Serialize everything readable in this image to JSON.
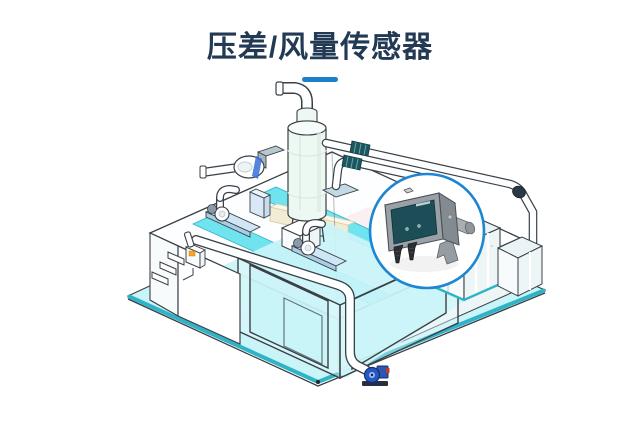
{
  "header": {
    "title": "压差/风量传感器",
    "divider": "title-underline-bar"
  },
  "illustration": {
    "alt": "isometric-cleanroom-hvac-system",
    "callout_device": "differential-pressure-air-volume-sensor",
    "elements": [
      "cleanroom-floor",
      "cleanroom-roof",
      "partition-walls",
      "scrubber-tank",
      "blower-pump",
      "roof-duct-fan-left",
      "roof-duct-fan-right",
      "exhaust-piping",
      "flex-duct-connector",
      "ahu-cabinet",
      "wall-control-box",
      "drain-pump",
      "sensor-callout-circle"
    ]
  },
  "colors": {
    "page-bg": "#ffffff",
    "title-color": "#223a54",
    "divider-color": "#1a80c9",
    "outline": "#3a4045",
    "floor-cyan": "#c9f4f8",
    "strip-cyan": "#6fe4ef",
    "edge-teal": "#2fb3c7",
    "wall-glass": "#e6fafc",
    "cream": "#f3ecd5",
    "pink": "#f9ecee",
    "pipe-white": "#fdfeff",
    "flex-teal": "#1f565e",
    "tank-mint": "#edf8f2",
    "equip-blue": "#3a6fd8",
    "base-blue": "#cfe6f5",
    "callout-blue": "#1c86d2",
    "sensor-top": "#c9cdd0",
    "sensor-front": "#9aa1a6",
    "sensor-side": "#848b90",
    "sensor-panel": "#1d4e57",
    "fitting-dark": "#2a2d31",
    "indicator-orange": "#f5a623",
    "pump-blue": "#2458c6"
  }
}
